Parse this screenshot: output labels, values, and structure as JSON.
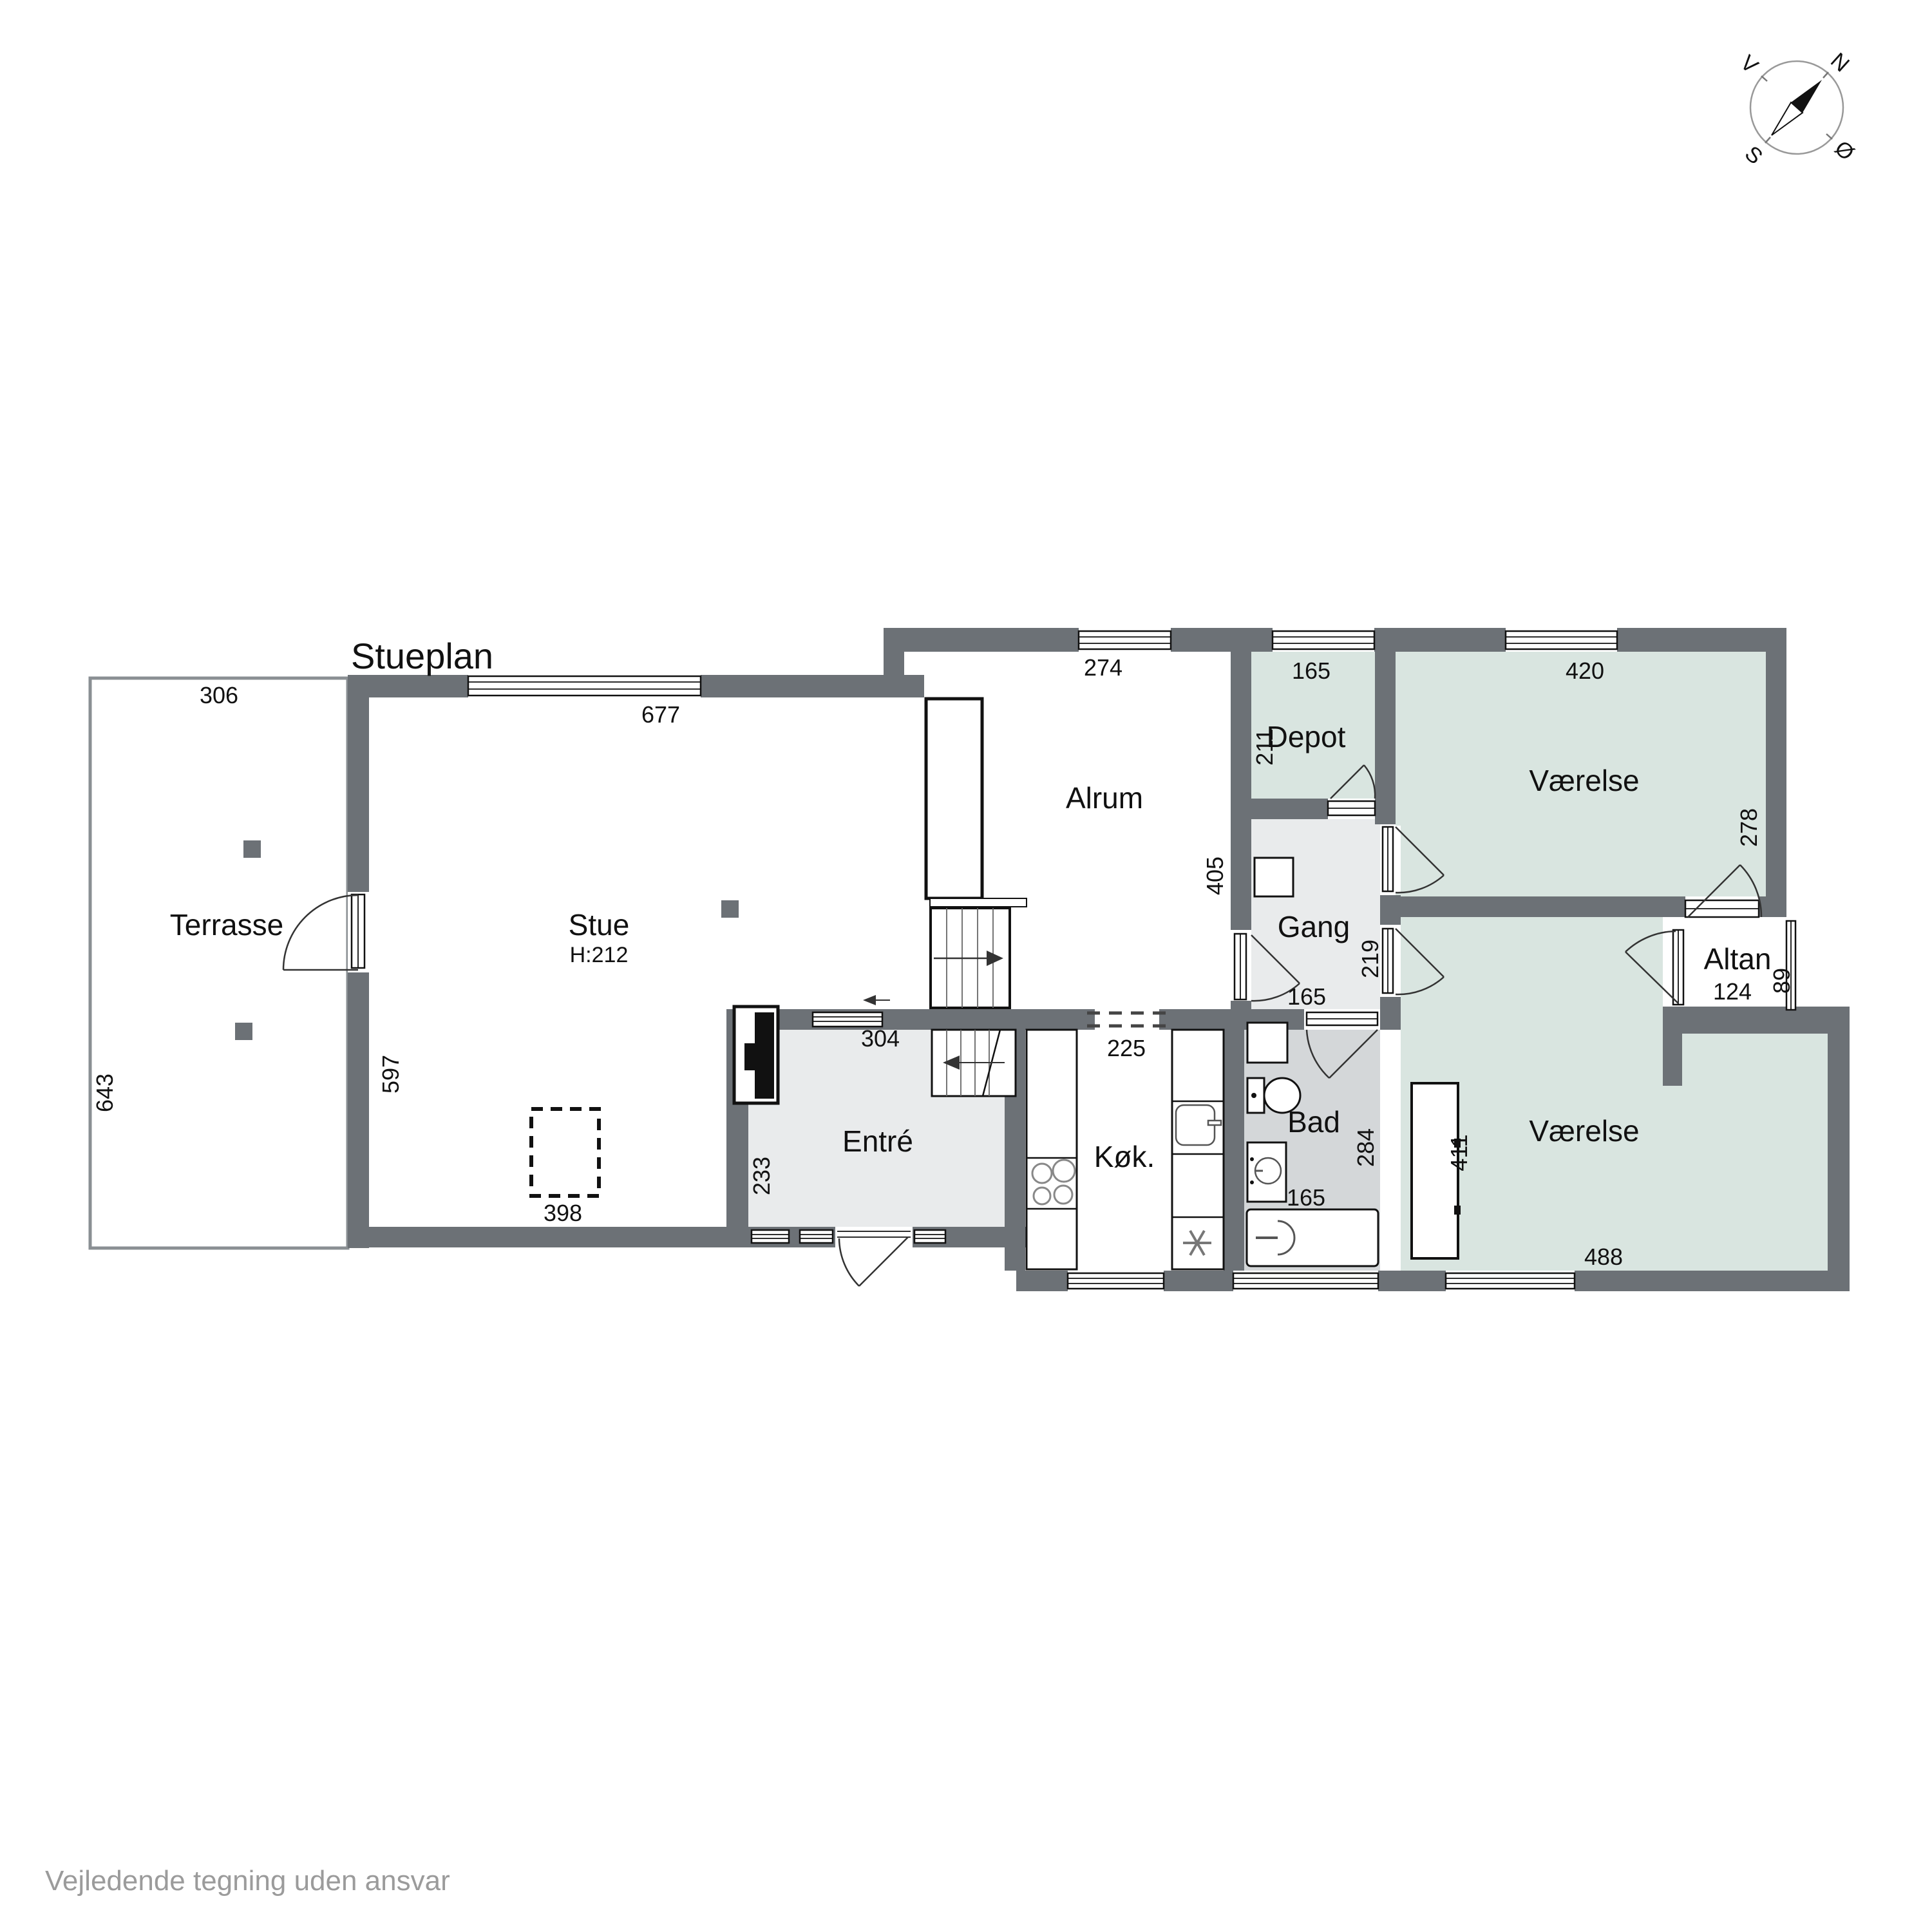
{
  "title": "Stueplan",
  "disclaimer": "Vejledende tegning uden ansvar",
  "compass": {
    "north": "N",
    "south": "S",
    "east": "Ø",
    "west": "V"
  },
  "rooms": {
    "terrasse": {
      "label": "Terrasse",
      "width": "306",
      "depth": "643"
    },
    "stue": {
      "label": "Stue",
      "ceiling": "H:212",
      "width": "677",
      "depth": "597",
      "feature": "398"
    },
    "alrum": {
      "label": "Alrum",
      "width": "274",
      "depth": "405",
      "opening_kitchen": "225"
    },
    "entre": {
      "label": "Entré",
      "width": "304",
      "depth": "233"
    },
    "kok": {
      "label": "Køk."
    },
    "depot": {
      "label": "Depot",
      "width": "165",
      "depth": "211"
    },
    "gang": {
      "label": "Gang",
      "door_width": "219",
      "opening_bad": "165"
    },
    "bad": {
      "label": "Bad",
      "depth": "284",
      "window": "165"
    },
    "vaerelse_nord": {
      "label": "Værelse",
      "width": "420",
      "depth": "278"
    },
    "vaerelse_syd": {
      "label": "Værelse",
      "width": "488",
      "depth": "411"
    },
    "altan": {
      "label": "Altan",
      "width": "124",
      "depth": "89"
    }
  },
  "colors": {
    "wall": "#6c7176",
    "room_green": "#d9e5e0",
    "room_gray": "#e9ebec",
    "bad_gray": "#d4d7d9",
    "terrace_outline": "#8a8f93"
  }
}
